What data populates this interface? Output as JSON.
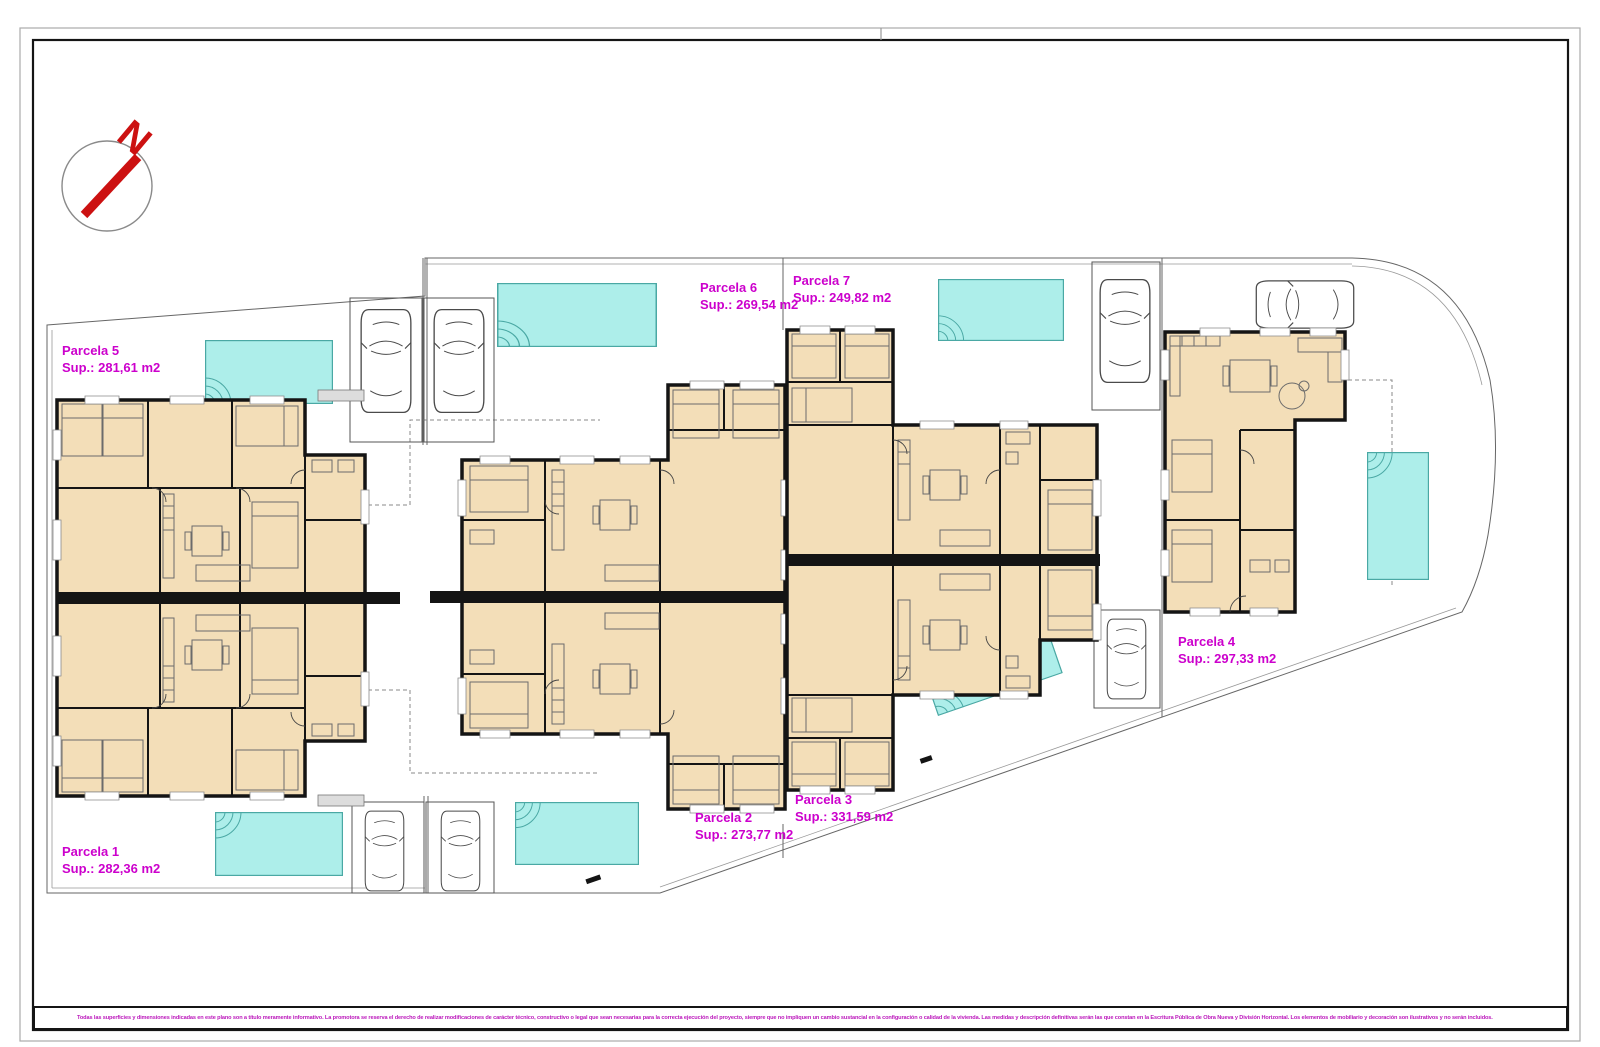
{
  "compass": {
    "north_label": "N",
    "color": "#cc1111"
  },
  "parcels": [
    {
      "name": "Parcela 1",
      "sup": "Sup.: 282,36 m2"
    },
    {
      "name": "Parcela 2",
      "sup": "Sup.: 273,77 m2"
    },
    {
      "name": "Parcela 3",
      "sup": "Sup.: 331,59 m2"
    },
    {
      "name": "Parcela 4",
      "sup": "Sup.: 297,33 m2"
    },
    {
      "name": "Parcela 5",
      "sup": "Sup.: 281,61 m2"
    },
    {
      "name": "Parcela 6",
      "sup": "Sup.: 269,54 m2"
    },
    {
      "name": "Parcela 7",
      "sup": "Sup.: 249,82 m2"
    }
  ],
  "footer": {
    "disclaimer": "Todas las superficies y dimensiones indicadas en este plano son a título meramente informativo. La promotora se reserva el derecho de realizar modificaciones de carácter técnico, constructivo o legal que sean necesarias para la correcta ejecución del proyecto, siempre que no impliquen un cambio sustancial en la configuración o calidad de la vivienda. Las medidas y descripción definitivas serán las que constan en la Escritura Pública de Obra Nueva y División Horizontal. Los elementos de mobiliario y decoración son ilustrativos y no serán incluidos."
  },
  "colors": {
    "label_magenta": "#cc00cc",
    "pool_fill": "#adeeea",
    "pool_stroke": "#4aa8a4",
    "floor_tan": "#f3deb8",
    "wall_black": "#141414",
    "frame_gray": "#aaaaaa",
    "compass_red": "#cc1111"
  }
}
